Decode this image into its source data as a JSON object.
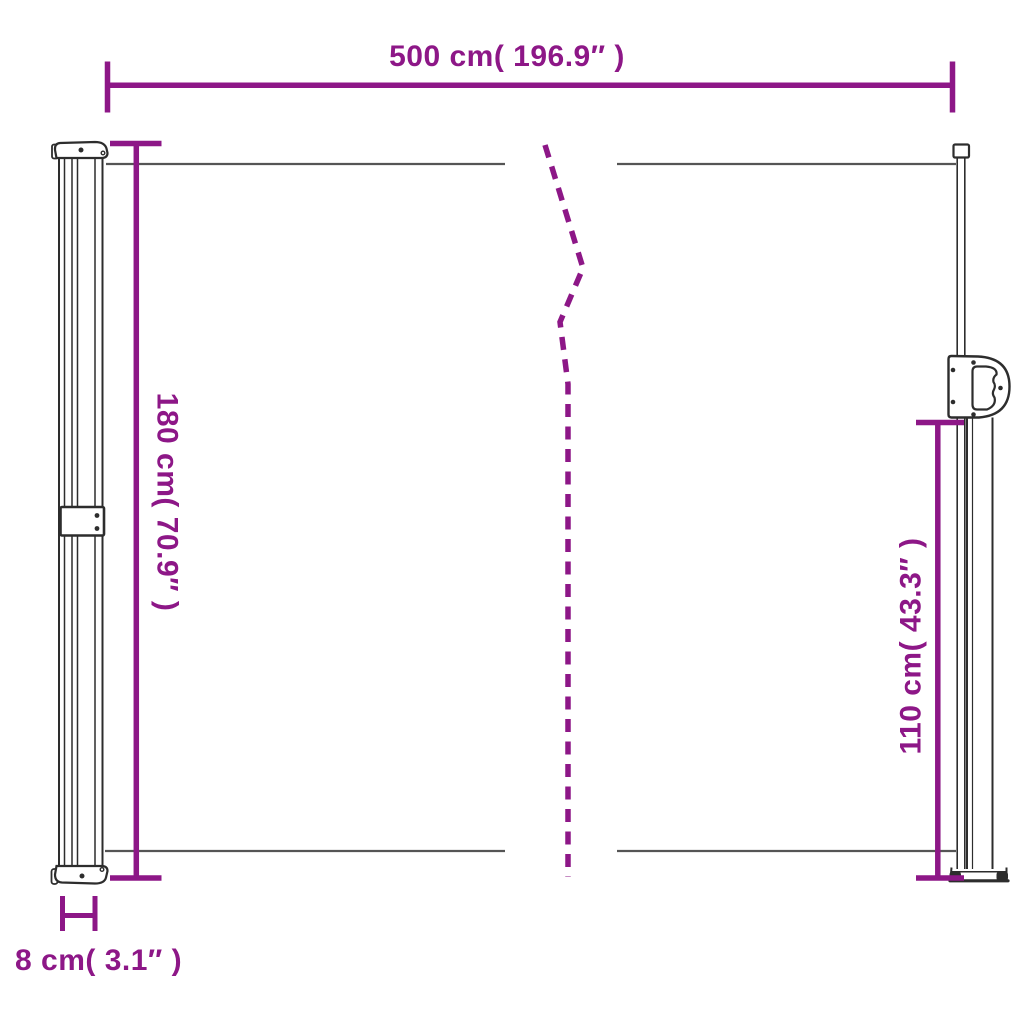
{
  "colors": {
    "accent": "#8D1787",
    "outline": "#2D2D2D",
    "fabric": "#555555",
    "background": "#FFFFFF"
  },
  "dimension_labels": {
    "width": "500 cm( 196.9″ )",
    "height_left": "180 cm( 70.9″ )",
    "height_right": "110 cm( 43.3″ )",
    "depth": "8 cm( 3.1″ )"
  }
}
